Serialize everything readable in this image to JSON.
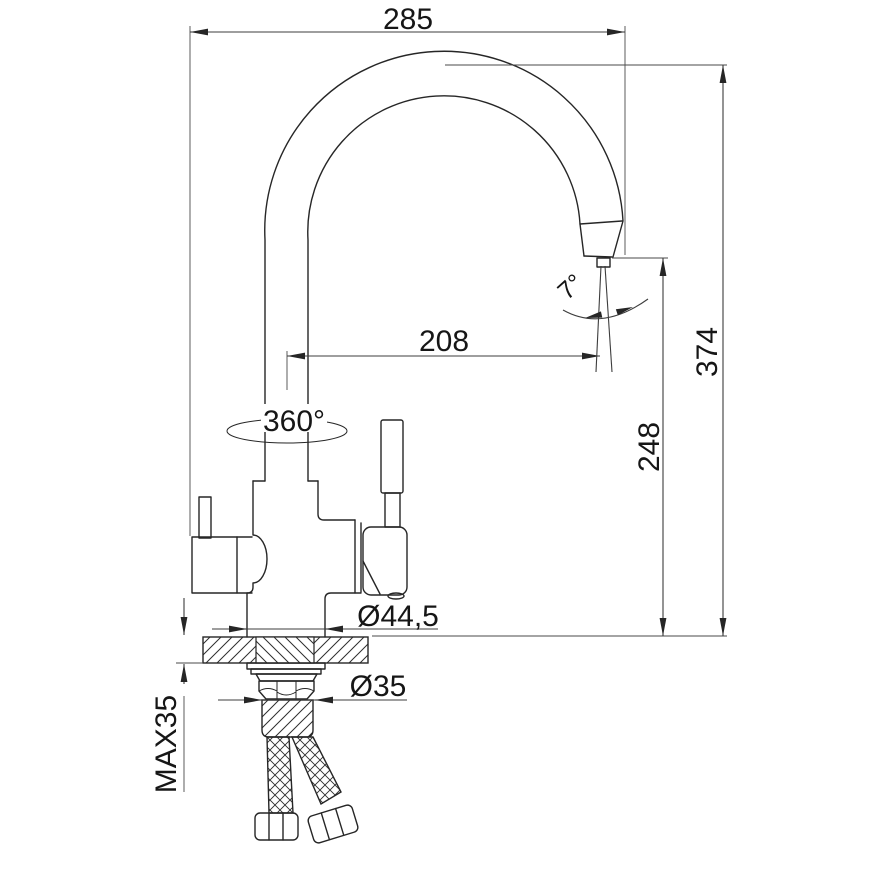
{
  "drawing": {
    "type": "technical-drawing",
    "subject": "kitchen faucet side elevation with installation dimensions",
    "colors": {
      "background": "#ffffff",
      "line": "#262626",
      "dimension": "#3d3d3d",
      "text": "#161616"
    },
    "labels": {
      "overall_width": "285",
      "overall_height": "374",
      "spout_outlet_height": "248",
      "spout_reach": "208",
      "swivel_angle": "360°",
      "outlet_angle": "7°",
      "body_base_diameter": "Ø44,5",
      "mounting_hole_diameter": "Ø35",
      "max_deck_thickness": "MAX35"
    }
  }
}
